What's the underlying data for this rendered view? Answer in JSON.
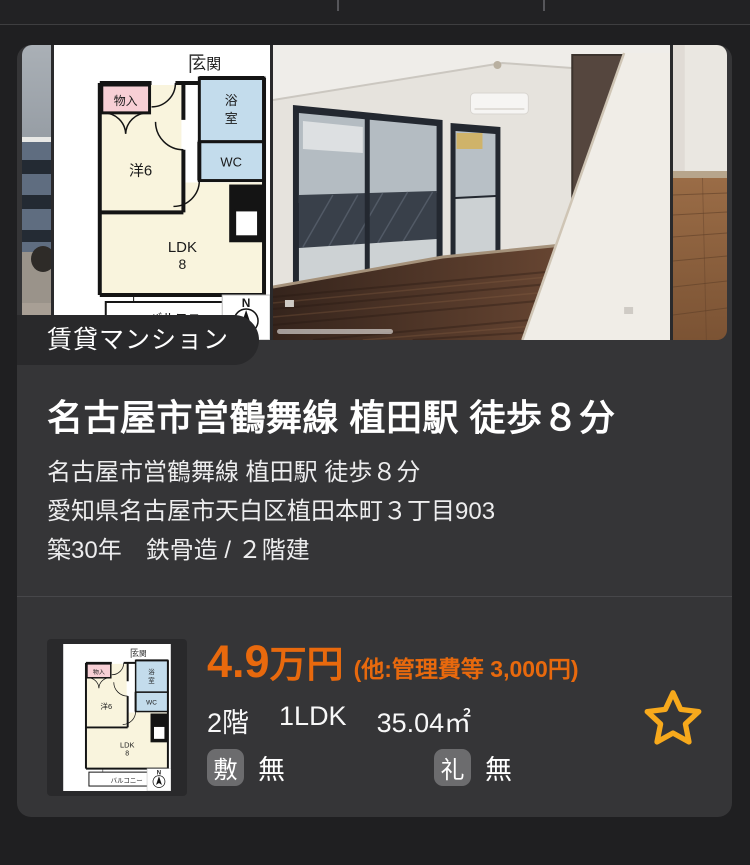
{
  "page": {
    "background": "#1f1f21"
  },
  "card": {
    "background": "#353537",
    "property_type": "賃貸マンション",
    "title": "名古屋市営鶴舞線 植田駅 徒歩８分",
    "details": [
      "名古屋市営鶴舞線 植田駅 徒歩８分",
      "愛知県名古屋市天白区植田本町３丁目903",
      "築30年　鉄骨造 / ２階建"
    ],
    "price": {
      "amount": "4.9",
      "unit": "万円",
      "extra": "(他:管理費等 3,000円)",
      "color": "#e8690d"
    },
    "specs": [
      "2階",
      "1LDK",
      "35.04㎡"
    ],
    "fees": [
      {
        "badge": "敷",
        "value": "無"
      },
      {
        "badge": "礼",
        "value": "無"
      }
    ],
    "favorite": {
      "icon": "star-outline",
      "color": "#f7a91c"
    }
  },
  "floorplan": {
    "labels": {
      "entrance": "玄関",
      "closet": "物入",
      "bath_1": "浴",
      "bath_2": "室",
      "wc": "WC",
      "room": "洋6",
      "ldk": "LDK",
      "ldk_size": "8",
      "balcony": "バルコニー",
      "compass": "N"
    }
  }
}
